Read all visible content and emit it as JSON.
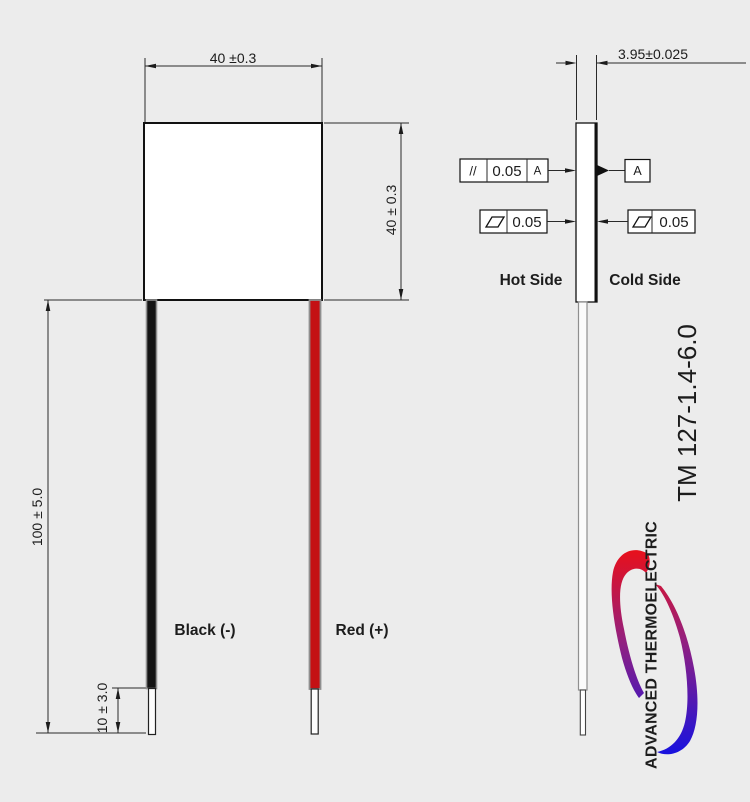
{
  "drawing": {
    "part_number": "TM 127-1.4-6.0",
    "front_view": {
      "width_dim": "40 ±0.3",
      "height_dim": "40 ± 0.3",
      "lead_length_dim": "100 ± 5.0",
      "bare_lead_dim": "10 ± 3.0",
      "black_lead_label": "Black (-)",
      "red_lead_label": "Red (+)"
    },
    "side_view": {
      "thickness_dim": "3.95±0.025",
      "hot_side_label": "Hot Side",
      "cold_side_label": "Cold Side",
      "parallelism": {
        "symbol": "//",
        "tolerance": "0.05",
        "datum_ref": "A"
      },
      "datum_flag": "A",
      "flatness_left": "0.05",
      "flatness_right": "0.05"
    },
    "logo": {
      "brand": "ADVANCED THERMOELECTRIC"
    }
  },
  "colors": {
    "background": "#ececec",
    "line": "#1c1c1c",
    "black_wire": "#141414",
    "red_wire": "#c41114",
    "wire_sheath": "#8f8f8f",
    "logo_red": "#e8101b",
    "logo_purple": "#93207f",
    "logo_blue": "#1a12dd"
  }
}
